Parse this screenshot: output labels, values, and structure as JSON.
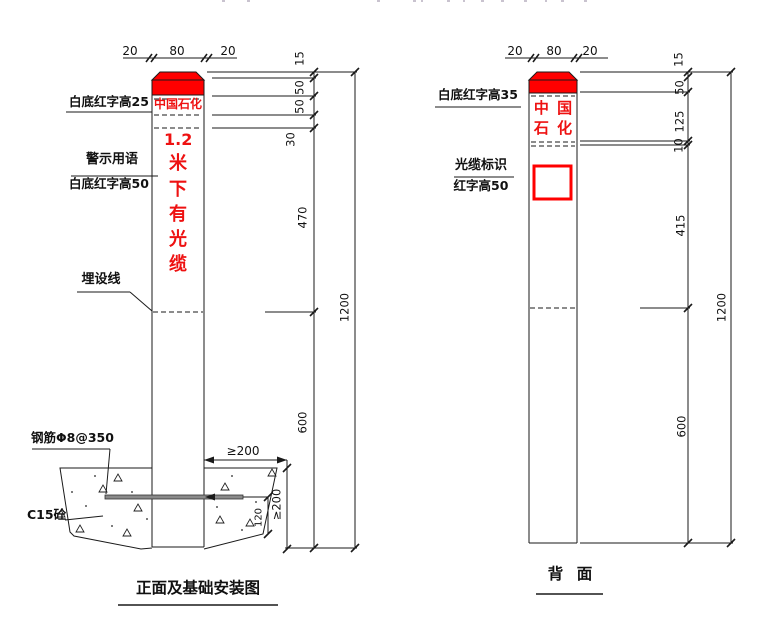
{
  "front_view": {
    "title": "正面及基础安装图",
    "top_dims": {
      "left": "20",
      "middle": "80",
      "right": "20"
    },
    "post": {
      "brand_text": "中国石化",
      "warning_chars": [
        "1.2",
        "米",
        "下",
        "有",
        "光",
        "缆"
      ]
    },
    "callouts": {
      "cap_note": "白底红字高25",
      "warning_note_line1": "警示用语",
      "warning_note_line2": "白底红字高50",
      "burial_line_note": "埋设线",
      "rebar_note": "钢筋Φ8@350",
      "concrete_note": "C15砼"
    },
    "dims": {
      "cap_top": "15",
      "cap_band": "50",
      "brand_band": "50",
      "gap": "30",
      "warning_zone": "470",
      "buried": "600",
      "total": "1200",
      "foundation_width": "≥200",
      "foundation_depth": "≥200",
      "bar_depth": "120"
    }
  },
  "back_view": {
    "title": "背 面",
    "top_dims": {
      "left": "20",
      "middle": "80",
      "right": "20"
    },
    "post": {
      "brand_line1": "中 国",
      "brand_line2": "石 化"
    },
    "callouts": {
      "cap_note": "白底红字高35",
      "marker_note_line1": "光缆标识",
      "marker_note_line2": "红字高50"
    },
    "dims": {
      "cap_top": "15",
      "cap_band": "50",
      "brand_band": "125",
      "gap": "10",
      "marker_zone": "415",
      "buried": "600",
      "total": "1200"
    }
  },
  "colors": {
    "red": "#ff0000",
    "red_text": "#ee1111",
    "line": "#1a1a1a"
  }
}
